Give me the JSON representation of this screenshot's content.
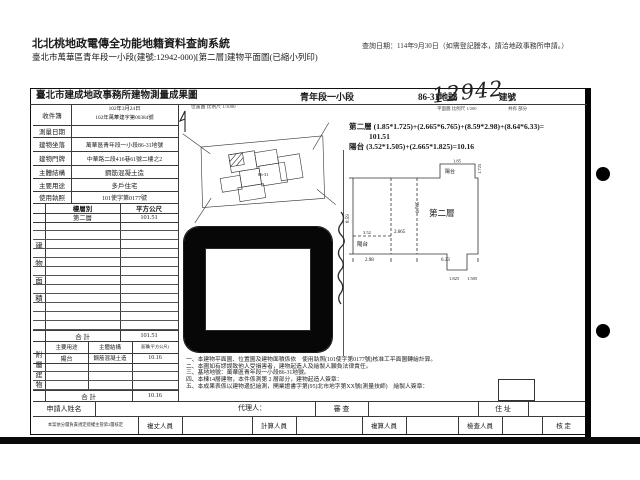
{
  "header": {
    "system_title": "北北桃地政電傳全功能地籍資料查詢系統",
    "query_date": "查詢日期：114年9月30日（如需登記謄本，請洽地政事務所申請。）",
    "doc_subtitle": "臺北市萬華區青年段一小段(建號:12942-000)[第二層]建物平面圖(已縮小列印)"
  },
  "form": {
    "title": "臺北市建成地政事務所建物測量成果圖",
    "section": "青年段一小段",
    "parcel": "86-31地號",
    "handwritten_no": "12942",
    "handwritten_label": "建號",
    "plan_scale_label": "平面圖 比例尺 1/200",
    "share_label": "共有 部分",
    "info_rows": [
      {
        "label": "收件簿",
        "value1": "102年3月24日",
        "value2": "102年萬華建字第00384號"
      },
      {
        "label": "測量日期",
        "value": ""
      },
      {
        "label": "建物坐落",
        "value": "萬華區青年段一小段86-31地號"
      },
      {
        "label": "建物門牌",
        "value": "中華路二段416巷61號二樓之2"
      },
      {
        "label": "主體結構",
        "value": "鋼筋混凝土造"
      },
      {
        "label": "主要用途",
        "value": "多戶住宅"
      },
      {
        "label": "使用執照",
        "value": "101使字第0177號"
      }
    ],
    "floor_table": {
      "side_label": "建物面積",
      "header_floor": "樓層別",
      "header_area": "平方公尺",
      "floor": "第二層",
      "area": "101.51",
      "total_label": "合 計",
      "total": "101.51"
    },
    "annex_table": {
      "side_label": "附屬建物",
      "h_use": "主要用途",
      "h_struct": "主體結構",
      "h_area": "面積(平方公尺)",
      "use": "陽台",
      "struct": "鋼筋混凝土造",
      "area": "10.16",
      "total_label": "合 計",
      "total": "10.16"
    }
  },
  "map": {
    "caption": "位置圖 比例尺 1/1000",
    "parcel": "86-31"
  },
  "calc": {
    "line1": "第二層 (1.85*1.725)+(2.665*6.765)+(8.59*2.98)+(8.64*6.33)=",
    "line2": "101.51",
    "line3": "陽台 (3.52*1.505)+(2.665*1.825)=10.16"
  },
  "plan": {
    "room": "第二層",
    "balcony": "陽台",
    "d_left": "8.59",
    "d_b1": "2.98",
    "d_b2": "6.33",
    "d_w": "2.665",
    "d_h": "6.765",
    "d_n1": "1.85",
    "d_n2": "1.725",
    "d_bw": "3.52",
    "d_bh": "1.505",
    "d_s": "1.825"
  },
  "notes": {
    "n1": "一、本建物平面圖、位置圖及建物面積係依　使用執照(101使字第0177號)核准工平面圖轉繪計算。",
    "n2": "二、本圖如有謬誤致他人受損害者，建物起造人及繪製人願負法律責任。",
    "n3": "三、基地地號：萬華區青年段一小段86-31地號。",
    "n4": "四、本棟14層建物，本件係測第 2 層部分，建物起造人簽章：",
    "n5": "五、本成果表係以建物邊記繪測，開業證書字第(95)北市地字第XX號(測量技師)　繪製人簽章："
  },
  "footer": {
    "applicant_label": "申請人姓名",
    "agent_label": "代理人：",
    "review_label": "審 查",
    "address_label": "住 址",
    "approve_note": "本案依分層負責規定授權主管第2層核定",
    "staff1": "複丈人員",
    "staff2": "計算人員",
    "staff3": "複算人員",
    "staff4": "檢查人員",
    "staff5": "核 定"
  }
}
